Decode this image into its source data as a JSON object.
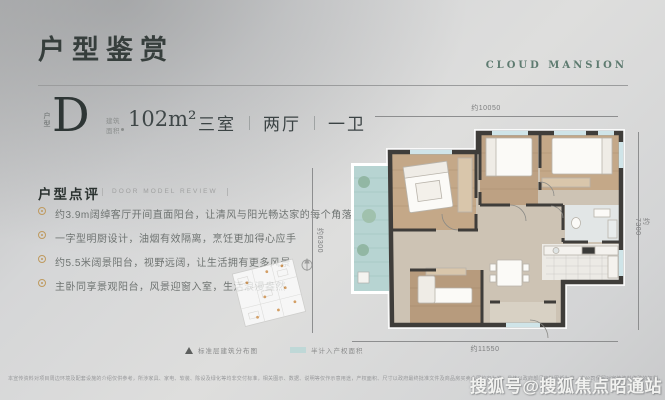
{
  "header": {
    "title": "户型鉴赏",
    "brand": "CLOUD MANSION"
  },
  "unit": {
    "type_label": "户型",
    "letter": "D",
    "area_label": "建筑面积",
    "area_value": "102m²",
    "rooms": [
      "三室",
      "两厅",
      "一卫"
    ]
  },
  "review": {
    "title": "户型点评",
    "subtitle": "DOOR MODEL REVIEW",
    "bullets": [
      "约3.9m阔绰客厅开间直面阳台，让清风与阳光畅达家的每个角落",
      "一字型明厨设计，油烟有效隔离，烹饪更加得心应手",
      "约5.5米阔景阳台，视野远阔，让生活拥有更多风景",
      "主卧同享景观阳台，风景迎窗入室，生活浪漫盎然"
    ]
  },
  "plan": {
    "dims": {
      "top": "约10050",
      "right": "约7300",
      "bottom": "约11550",
      "left": "约6300"
    }
  },
  "legend": {
    "north_label": "标准层建筑分布图",
    "swatch_label": "半计入产权面积",
    "swatch_color": "#bfd8d7"
  },
  "footer": {
    "disclaimer": "本宣传资料对项目周边环境及配套设施的介绍仅供参考，所涉家具、家电、软装、陈设及绿化等均非交付标准，相关图示、数据、说明等仅作示意用途，产权面积、尺寸以政府最终批准文件及商品房买卖合同约定为准，具体以政府部门审批图纸为准，本公司保留对宣传资料修改的权利，敬请留意最新资料。",
    "watermark": "搜狐号@搜狐焦点昭通站"
  },
  "colors": {
    "brand_teal": "#5e7b70",
    "bullet_gold": "#bf9a5f",
    "wall_dark": "#3f3d3a",
    "balcony_teal": "#b7d4d2",
    "wood": "#c4a888",
    "background_gray": "#d5d6d7"
  }
}
